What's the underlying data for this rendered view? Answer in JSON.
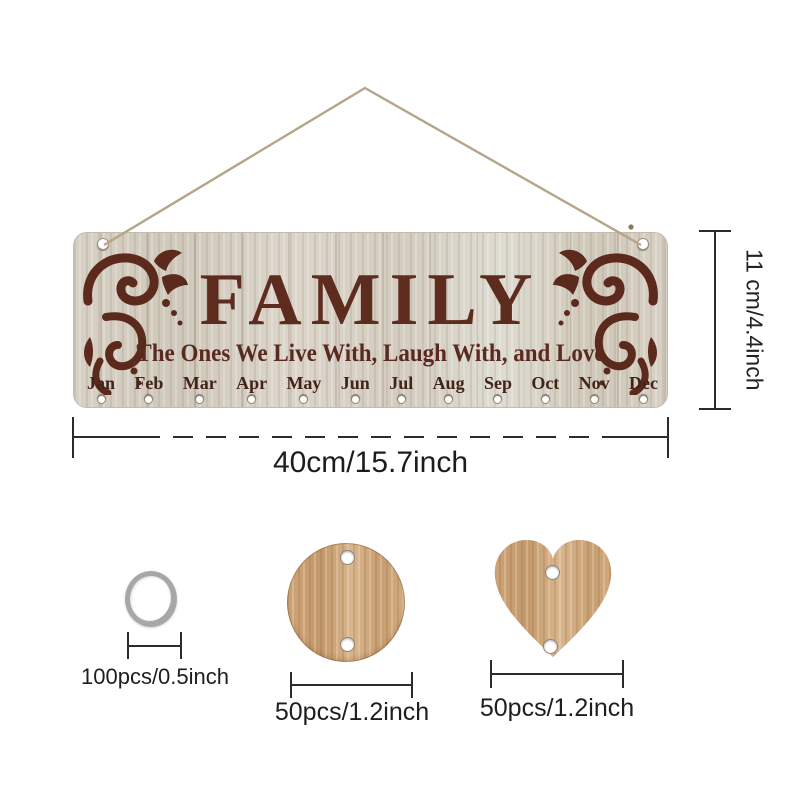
{
  "board": {
    "title": "FAMILY",
    "subtitle": "The Ones We Live With, Laugh With, and Love",
    "months": [
      "Jan",
      "Feb",
      "Mar",
      "Apr",
      "May",
      "Jun",
      "Jul",
      "Aug",
      "Sep",
      "Oct",
      "Nov",
      "Dec"
    ]
  },
  "dimensions": {
    "board_width": "40cm/15.7inch",
    "board_height": "11 cm/4.4inch"
  },
  "accessories": {
    "ring_label": "100pcs/0.5inch",
    "disc_label": "50pcs/1.2inch",
    "heart_label": "50pcs/1.2inch"
  },
  "colors": {
    "engraving_brown": "#5b2a1d",
    "board_wood": "#d8d1c5",
    "accessory_wood": "#cfa87e",
    "ring_metal": "#a7a7a7",
    "dimension_line": "#2b2b2b",
    "string_tan": "#b5a687",
    "background": "#ffffff"
  }
}
